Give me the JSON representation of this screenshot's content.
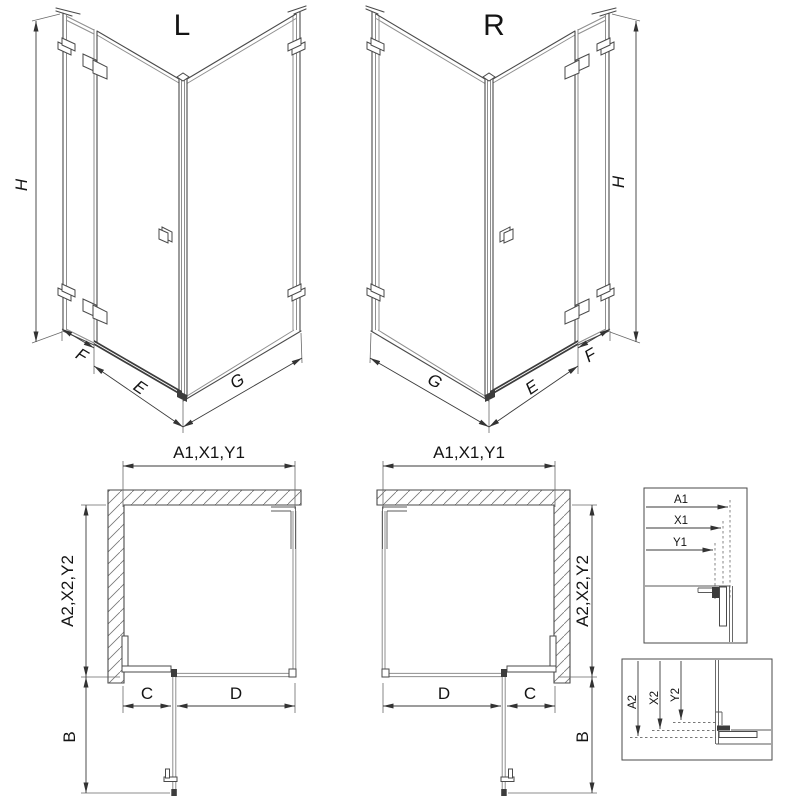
{
  "sheet": {
    "iso_left": {
      "variant": "L",
      "height": "H",
      "fixed_width": "F",
      "door_width": "E",
      "side_width": "G"
    },
    "iso_right": {
      "variant": "R",
      "height": "H",
      "fixed_width": "F",
      "door_width": "E",
      "side_width": "G"
    },
    "plan_left": {
      "width_dims": "A1,X1,Y1",
      "depth_dims": "A2,X2,Y2",
      "fixed_segment": "C",
      "door_segment": "D",
      "door_projection": "B"
    },
    "plan_right": {
      "width_dims": "A1,X1,Y1",
      "depth_dims": "A2,X2,Y2",
      "fixed_segment": "C",
      "door_segment": "D",
      "door_projection": "B"
    },
    "detail_width": {
      "labels": [
        "A1",
        "X1",
        "Y1"
      ]
    },
    "detail_depth": {
      "labels": [
        "A2",
        "X2",
        "Y2"
      ]
    }
  }
}
